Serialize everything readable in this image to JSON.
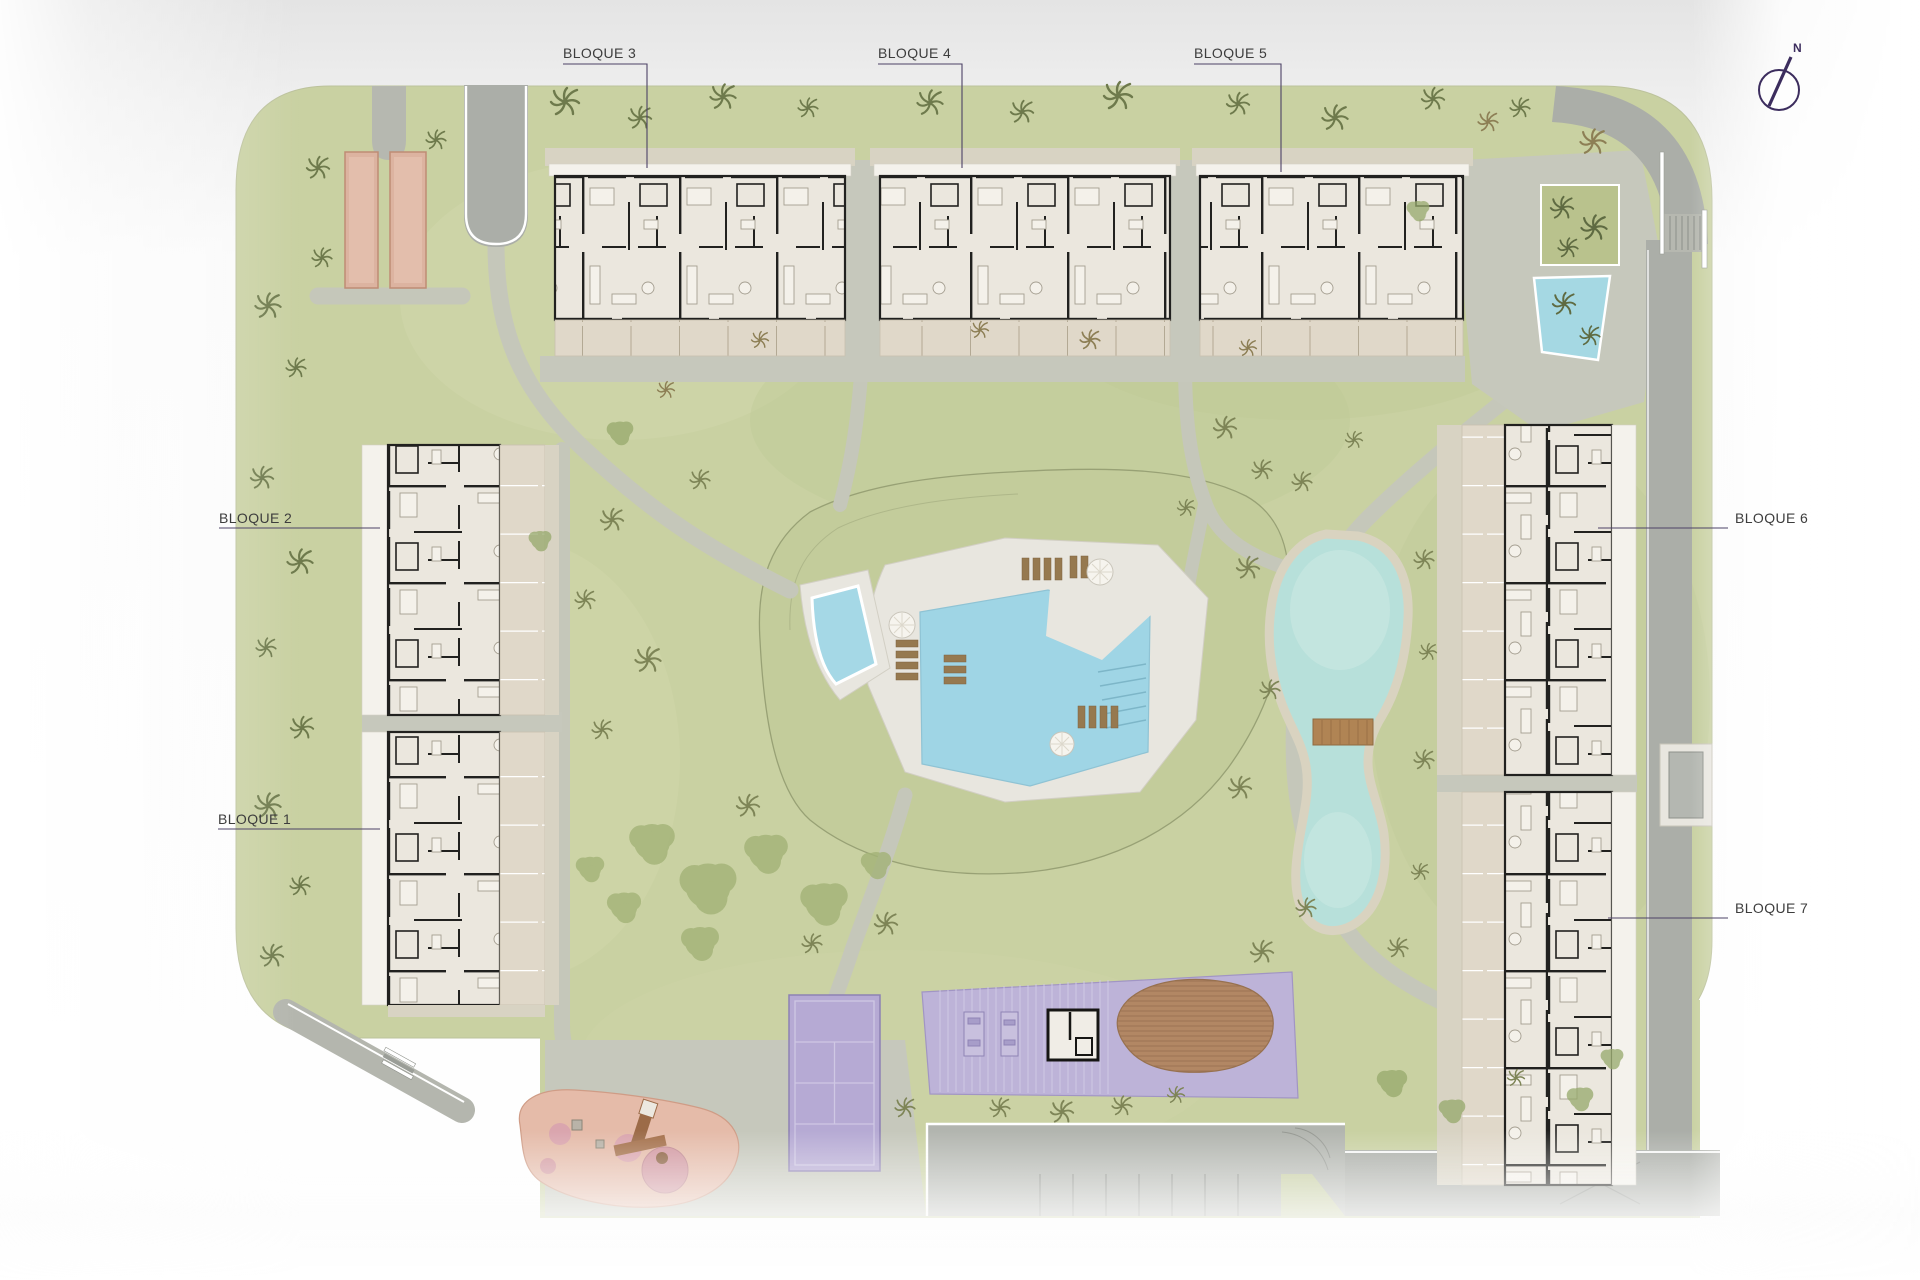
{
  "site_plan": {
    "labels": {
      "b1": "BLOQUE 1",
      "b2": "BLOQUE 2",
      "b3": "BLOQUE 3",
      "b4": "BLOQUE 4",
      "b5": "BLOQUE 5",
      "b6": "BLOQUE 6",
      "b7": "BLOQUE 7"
    },
    "north_indicator": "N",
    "palette": {
      "grass": "#c9d1a2",
      "mound_grass": "#c3cc9b",
      "path": "#c5c7ba",
      "road": "#abaea8",
      "stone": "#d8d3c3",
      "roof_white": "#f4f2ec",
      "plan_floor": "#ebe7de",
      "plan_wall": "#21211f",
      "terrace": "#e0d8c9",
      "pool_water": "#9fd5e5",
      "lake_water": "#b7e0da",
      "lake_shore": "#d9d3c0",
      "deck_white": "#e8e6df",
      "court_purple": "#b6aad4",
      "pergola_purple": "#bdb3d8",
      "wood_deck": "#b28764",
      "bridge_wood": "#b08454",
      "playground_pink": "#e5bba9",
      "play_circle": "#cf93a0",
      "petanque_salmon": "#dcb3a0",
      "parking": "#b2b5af",
      "curb_white": "#ffffff",
      "label_text": "#3d3d3d",
      "leader_line": "#4c4266",
      "north_purple": "#3c2d5e",
      "umbrella": "#f6f4ee",
      "lounger": "#96794f"
    }
  }
}
